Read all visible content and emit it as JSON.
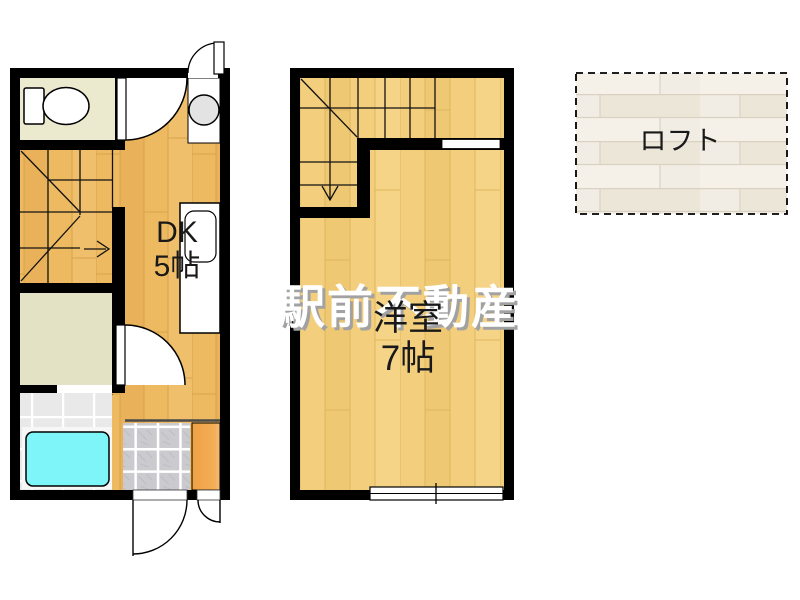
{
  "floor1": {
    "dk_label": {
      "line1": "DK",
      "line2": "5帖"
    }
  },
  "floor2": {
    "room_label": {
      "line1": "洋室",
      "line2": "7帖"
    }
  },
  "loft": {
    "label": "ロフト"
  },
  "watermark": {
    "text": "駅前不動産"
  },
  "colors": {
    "wall": "#000000",
    "background": "#FFFFFF",
    "floor_1f": "#EDBA62",
    "floor_2f": "#F2CE7D",
    "toilet_floor": "#EBE9CE",
    "washroom_floor": "#E3E2C5",
    "bathroom_floor": "#E9E9E9",
    "bathtub": "#7EF6F9",
    "entrance_tile": "#CBCACF",
    "shoe_cabinet": "#F0A245",
    "loft_floor": "#F2EDE4",
    "label_text": "#191919",
    "watermark_fill": "#FFFFFF",
    "watermark_shadow": "#A2A2A2"
  }
}
